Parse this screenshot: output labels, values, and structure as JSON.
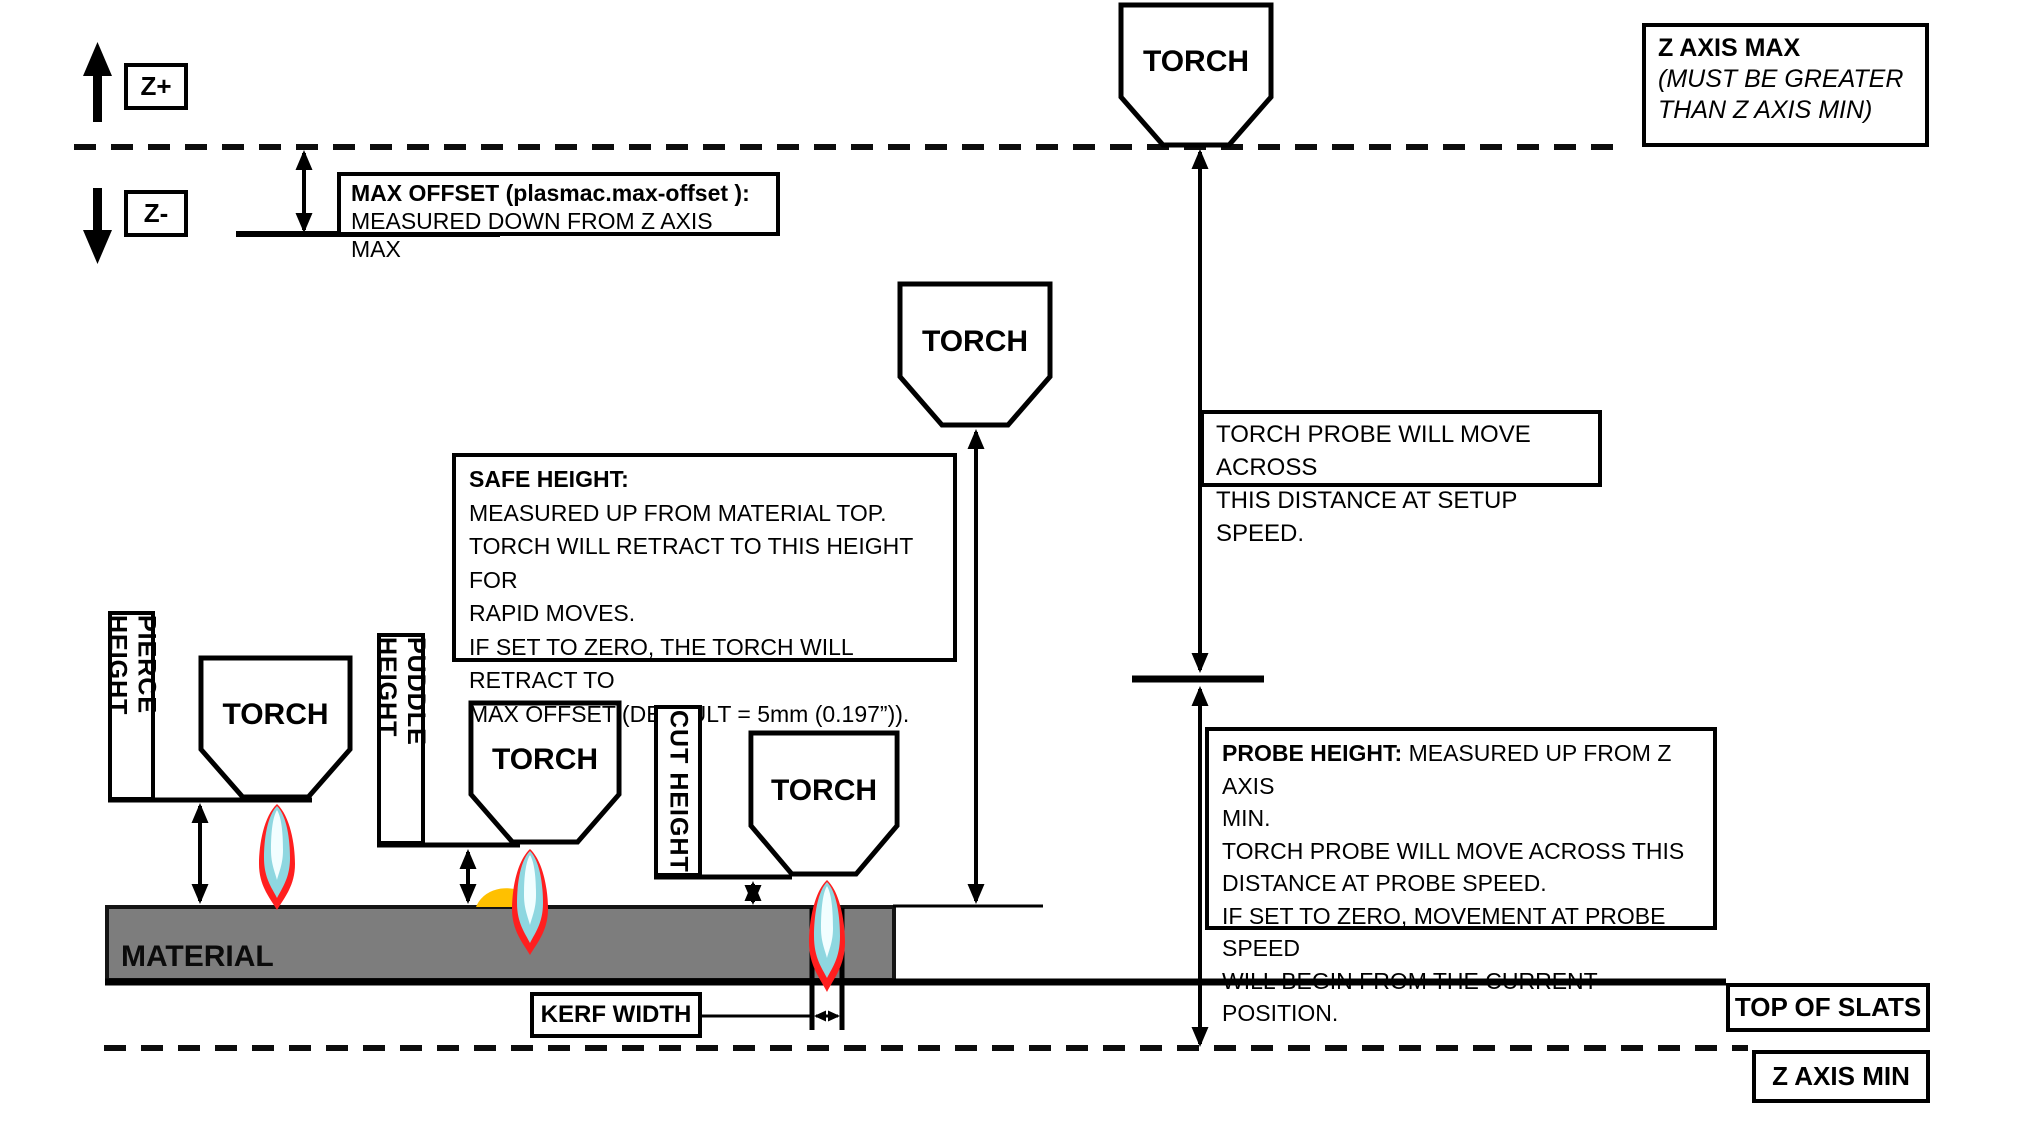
{
  "axis": {
    "z_plus": "Z+",
    "z_minus": "Z-"
  },
  "labels": {
    "torch": "TORCH",
    "material": "MATERIAL"
  },
  "boxes": {
    "max_offset": {
      "title": "MAX OFFSET (plasmac.max-offset ):",
      "subtitle": "MEASURED DOWN FROM Z AXIS MAX"
    },
    "z_axis_max": {
      "title": "Z AXIS MAX",
      "note1": "(MUST BE GREATER",
      "note2": "THAN Z AXIS MIN)"
    },
    "torch_probe": {
      "line1": "TORCH PROBE WILL MOVE ACROSS",
      "line2": "THIS DISTANCE AT SETUP SPEED."
    },
    "safe_height": {
      "heading": "SAFE HEIGHT:",
      "body": "\nMEASURED UP FROM MATERIAL TOP.\nTORCH WILL RETRACT TO THIS HEIGHT FOR\nRAPID MOVES.\nIF SET TO ZERO, THE TORCH WILL RETRACT TO\nMAX OFFSET (DEFAULT = 5mm (0.197”))."
    },
    "probe_height": {
      "heading": "PROBE HEIGHT:",
      "body": " MEASURED UP FROM Z AXIS\nMIN.\nTORCH PROBE WILL MOVE ACROSS THIS\nDISTANCE AT PROBE SPEED.\nIF SET TO ZERO,  MOVEMENT AT PROBE SPEED\nWILL BEGIN FROM THE CURRENT POSITION."
    },
    "kerf_width": "KERF WIDTH",
    "top_of_slats": "TOP OF SLATS",
    "z_axis_min": "Z AXIS MIN",
    "pierce_height": "PIERCE HEIGHT",
    "puddle_height": "PUDDLE HEIGHT",
    "cut_height": "CUT HEIGHT"
  },
  "colors": {
    "material": "#7d7d7d",
    "puddle": "#ffc000",
    "flame_outer": "#ff1f1f",
    "flame_mid": "#8ed7e0",
    "flame_core": "#f2feff",
    "line": "#000000"
  }
}
